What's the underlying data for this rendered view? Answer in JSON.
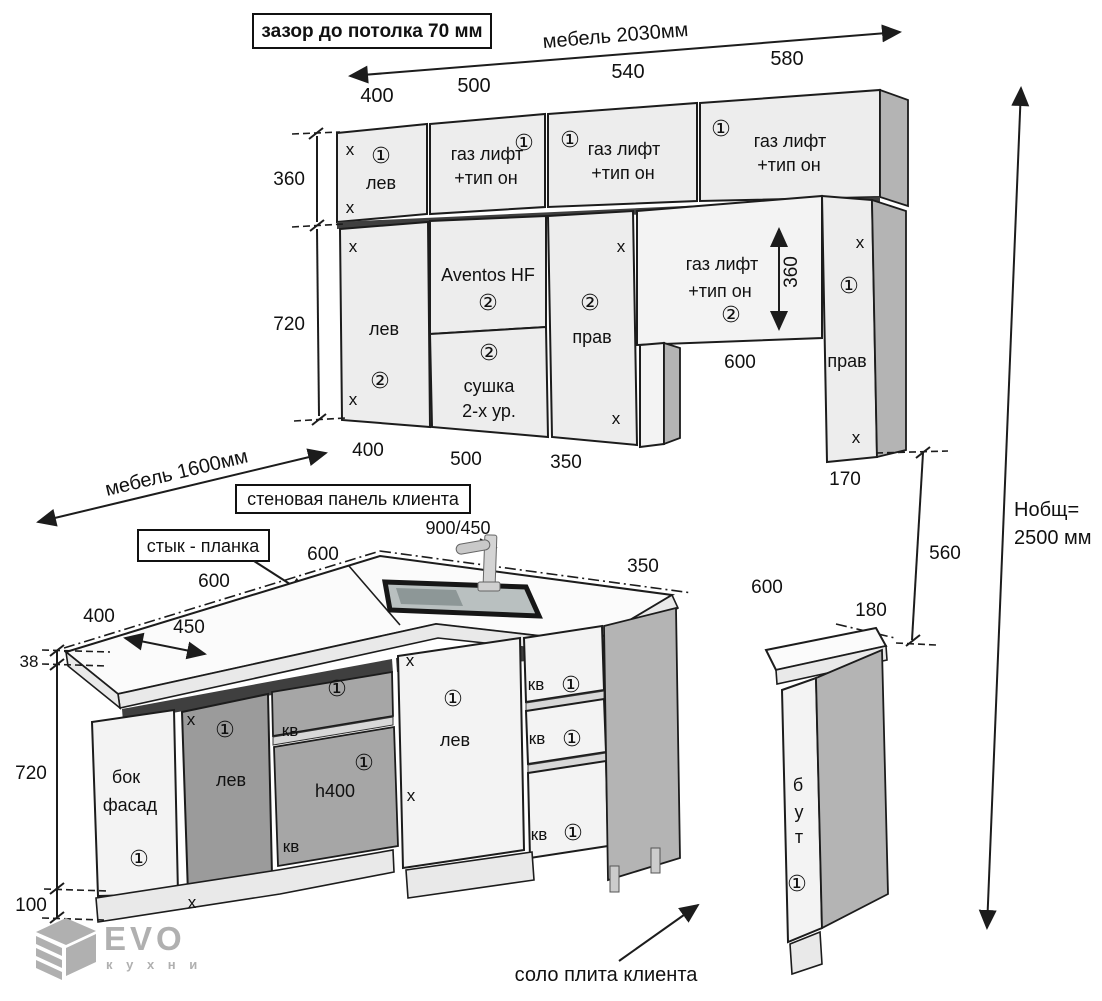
{
  "title": "Kitchen furniture assembly drawing",
  "colors": {
    "line": "#1c1c1c",
    "cabinet_light": "#ededed",
    "cabinet_dark": "#9b9b9b",
    "side_gray": "#b4b4b4",
    "logo_gray": "#b0b0b0"
  },
  "notes": {
    "gap": "зазор до потолка 70 мм",
    "wall_panel": "стеновая панель клиента",
    "joint": "стык - планка",
    "stove": "соло плита клиента"
  },
  "dims": {
    "d2030": "мебель 2030мм",
    "d1600": "мебель 1600мм",
    "d400": "400",
    "d500": "500",
    "d540": "540",
    "d580": "580",
    "d350": "350",
    "d360": "360",
    "d720": "720",
    "d170": "170",
    "d600": "600",
    "d560": "560",
    "d180": "180",
    "d450": "450",
    "d38": "38",
    "d100": "100",
    "sink": "900/450",
    "total1": "Нобщ=",
    "total2": "2500 мм"
  },
  "cab": {
    "gas1": "газ лифт",
    "gas2": "+тип он",
    "lev": "лев",
    "prav": "прав",
    "aventos": "Aventos HF",
    "dry1": "сушка",
    "dry2": "2-х ур.",
    "bok1": "бок",
    "bok2": "фасад",
    "h400": "h400",
    "b": "б",
    "u": "у",
    "t": "т"
  },
  "shared": {
    "x": "x",
    "n1": "①",
    "n2": "②",
    "kv": "кв"
  },
  "logo": {
    "name": "EVO",
    "sub": "к у х н и"
  }
}
